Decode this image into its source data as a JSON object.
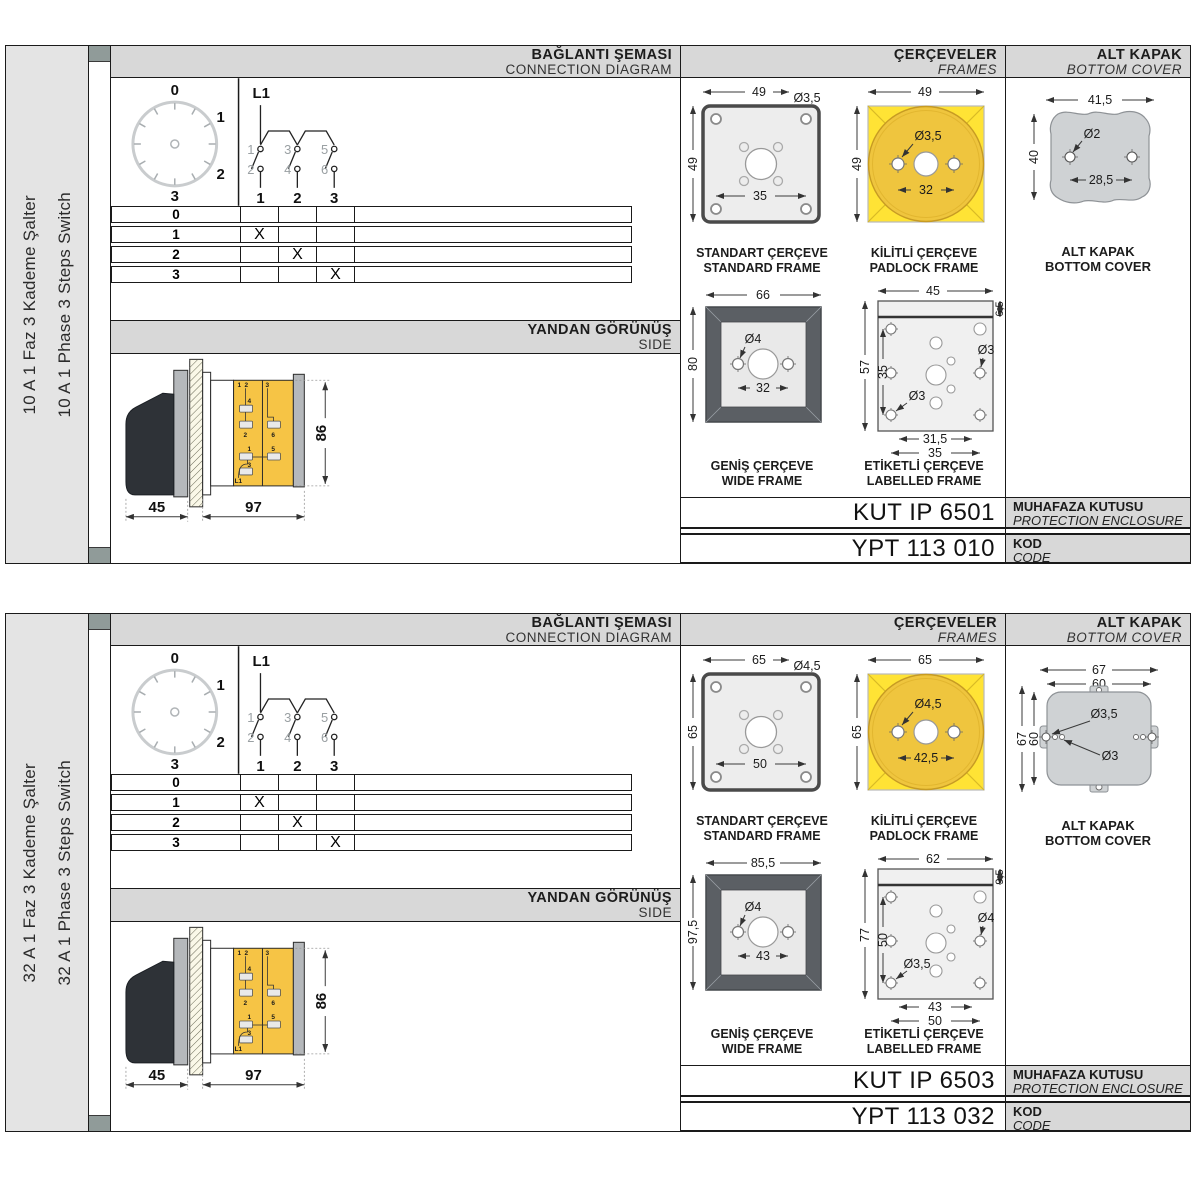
{
  "shared": {
    "headers": {
      "connection_tr": "BAĞLANTI ŞEMASI",
      "connection_en": "CONNECTION DIAGRAM",
      "frames_tr": "ÇERÇEVELER",
      "frames_en": "FRAMES",
      "cover_tr": "ALT KAPAK",
      "cover_en": "BOTTOM COVER",
      "side_tr": "YANDAN GÖRÜNÜŞ",
      "side_en": "SIDE",
      "enclosure_tr": "MUHAFAZA KUTUSU",
      "enclosure_en": "PROTECTION ENCLOSURE",
      "code_tr": "KOD",
      "code_en": "CODE"
    },
    "frame_labels": {
      "standard_tr": "STANDART ÇERÇEVE",
      "standard_en": "STANDARD FRAME",
      "padlock_tr": "KİLİTLİ ÇERÇEVE",
      "padlock_en": "PADLOCK FRAME",
      "wide_tr": "GENİŞ ÇERÇEVE",
      "wide_en": "WIDE FRAME",
      "labelled_tr": "ETİKETLİ ÇERÇEVE",
      "labelled_en": "LABELLED FRAME"
    },
    "cover_label": {
      "tr": "ALT KAPAK",
      "en": "BOTTOM COVER"
    },
    "dial": {
      "p0": "0",
      "p1": "1",
      "p2": "2",
      "p3": "3"
    },
    "schematic": {
      "feed": "L1",
      "c1": "1",
      "c2": "2",
      "c3": "3",
      "c4": "4",
      "c5": "5",
      "c6": "6",
      "t1": "1",
      "t2": "2",
      "t3": "3"
    },
    "table": {
      "rows": [
        {
          "label": "0",
          "c1": "",
          "c2": "",
          "c3": ""
        },
        {
          "label": "1",
          "c1": "X",
          "c2": "",
          "c3": ""
        },
        {
          "label": "2",
          "c1": "",
          "c2": "X",
          "c3": ""
        },
        {
          "label": "3",
          "c1": "",
          "c2": "",
          "c3": "X"
        }
      ]
    },
    "sideview": {
      "dim_handle": "45",
      "dim_body": "97",
      "dim_height": "86",
      "labels": {
        "tl1": "1",
        "tl2": "2",
        "tc2": "3",
        "t4": "4",
        "t2": "2",
        "t1": "1",
        "t3": "3",
        "t6": "6",
        "t5": "5",
        "feed": "L1"
      }
    },
    "colors": {
      "yellow": "#FFE335",
      "gold": "#EFC53E",
      "frame_dark_gray": "#5B5F64",
      "panel_gray": "#EDEDED",
      "cover_gray": "#CFD2D4",
      "header_gray": "#D8D8D8",
      "sidebar_gray": "#E4E4E4",
      "body_yellow": "#F6C445",
      "strip_square": "#909B99"
    }
  },
  "sections": [
    {
      "sidebar_tr": "10 A 1 Faz 3 Kademe Şalter",
      "sidebar_en": "10 A 1 Phase 3 Steps Switch",
      "standard": {
        "top": "49",
        "left": "49",
        "inner": "35",
        "dia": "Ø3,5"
      },
      "padlock": {
        "top": "49",
        "left": "49",
        "inner": "32",
        "dia": "Ø3,5"
      },
      "wide": {
        "top": "66",
        "left": "80",
        "inner": "32",
        "dia": "Ø4"
      },
      "labelled": {
        "top": "45",
        "right": "6,5",
        "left": "57",
        "inner_left": "35",
        "dia_tr": "Ø3",
        "dia_bl": "Ø3",
        "b1": "31,5",
        "b2": "35"
      },
      "cover": {
        "dim_top": "41,5",
        "dim_left": "40",
        "dia": "Ø2",
        "dim_inner": "28,5"
      },
      "kut": "KUT IP 6501",
      "ypt": "YPT 113 010"
    },
    {
      "sidebar_tr": "32 A 1 Faz 3 Kademe Şalter",
      "sidebar_en": "32 A 1 Phase 3 Steps Switch",
      "standard": {
        "top": "65",
        "left": "65",
        "inner": "50",
        "dia": "Ø4,5"
      },
      "padlock": {
        "top": "65",
        "left": "65",
        "inner": "42,5",
        "dia": "Ø4,5"
      },
      "wide": {
        "top": "85,5",
        "left": "97,5",
        "inner": "43",
        "dia": "Ø4"
      },
      "labelled": {
        "top": "62",
        "right": "9,5",
        "left": "77",
        "inner_left": "50",
        "dia_tr": "Ø4",
        "dia_bl": "Ø3,5",
        "b1": "43",
        "b2": "50"
      },
      "cover": {
        "dim_top": "67",
        "dim_top2": "60",
        "dim_left": "67",
        "dim_left2": "60",
        "dia": "Ø3,5",
        "dia2": "Ø3"
      },
      "kut": "KUT IP 6503",
      "ypt": "YPT 113 032"
    }
  ]
}
